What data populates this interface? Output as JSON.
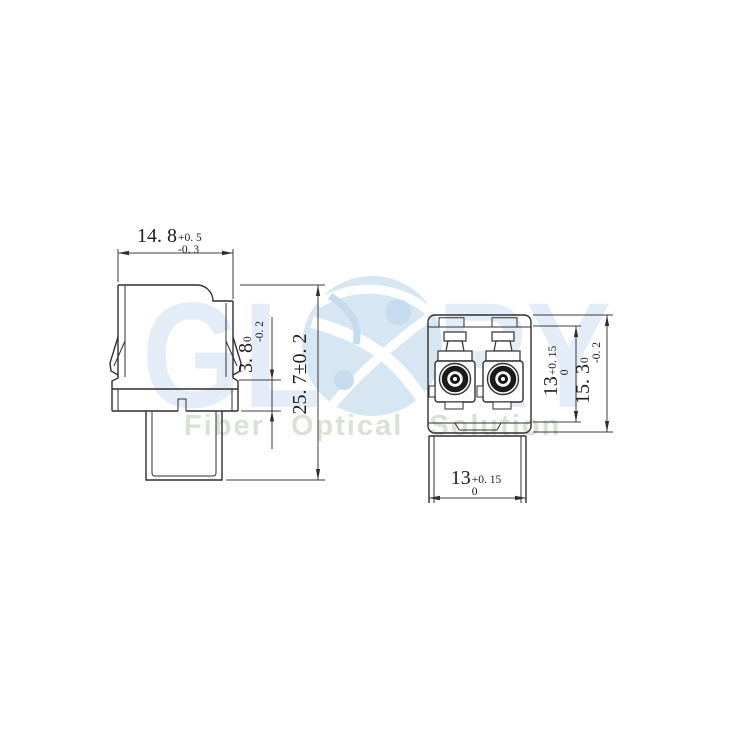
{
  "watermark": {
    "brand_left": "GL",
    "brand_right": "RY",
    "tagline": "Fiber Optical Solution",
    "brand_color": "#e4edf7",
    "globe_color": "#d7e6f3",
    "tagline_color": "#d9e3d3"
  },
  "drawing": {
    "background": "#ffffff",
    "object_line_color": "#2f2f2f",
    "dimension_line_color": "#3c3c3c",
    "views": [
      "side-view",
      "front-view"
    ]
  },
  "dimensions": {
    "top_width": {
      "value": "14. 8",
      "tol_upper": "+0. 5",
      "tol_lower": "-0. 3"
    },
    "latch_section_height": {
      "value": "3. 8",
      "tol_upper": "0",
      "tol_lower": "-0. 2"
    },
    "overall_height": {
      "value": "25. 7±0. 2"
    },
    "port_field_height": {
      "value": "13",
      "tol_upper": "+0. 15",
      "tol_lower": "0"
    },
    "body_height": {
      "value": "15. 3",
      "tol_upper": "0",
      "tol_lower": "-0. 2"
    },
    "body_width": {
      "value": "13",
      "tol_upper": "+0. 15",
      "tol_lower": "0"
    }
  }
}
